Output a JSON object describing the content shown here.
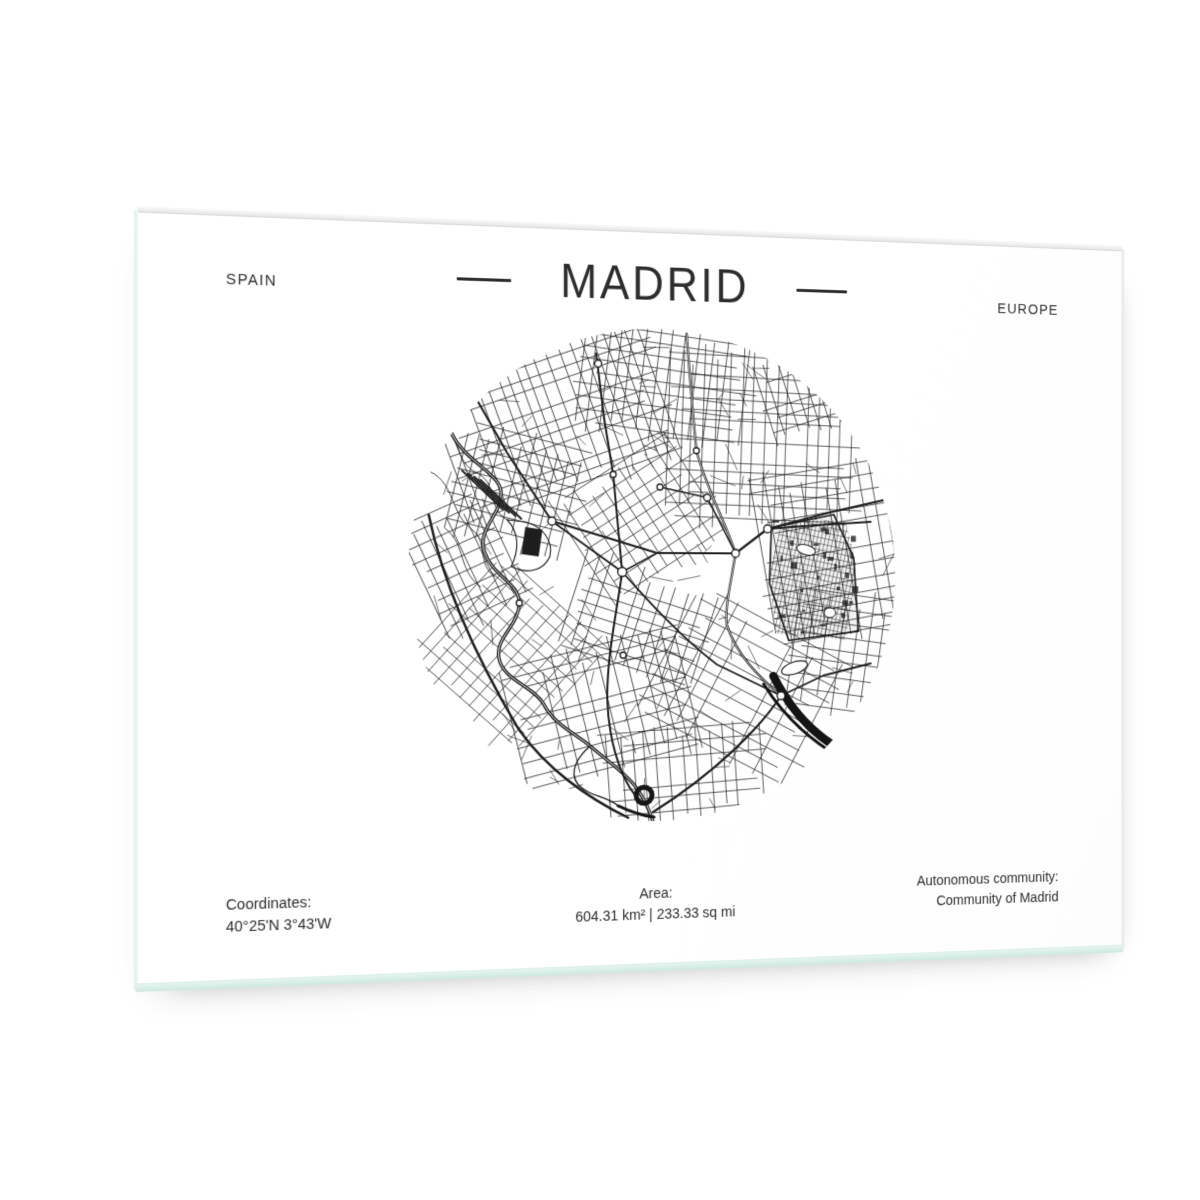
{
  "poster": {
    "header": {
      "country": "SPAIN",
      "title": "MADRID",
      "continent": "EUROPE"
    },
    "footer": {
      "coordinates_label": "Coordinates:",
      "coordinates_value": "40°25'N 3°43'W",
      "area_label": "Area:",
      "area_value": "604.31 km² | 233.33 sq mi",
      "community_label": "Autonomous community:",
      "community_value": "Community of Madrid"
    }
  },
  "colors": {
    "page_background": "#ffffff",
    "paper": "#ffffff",
    "ink": "#2d2d2d",
    "map_ink": "#1f1f1f",
    "glass_edge_tint": "#cde8df"
  }
}
